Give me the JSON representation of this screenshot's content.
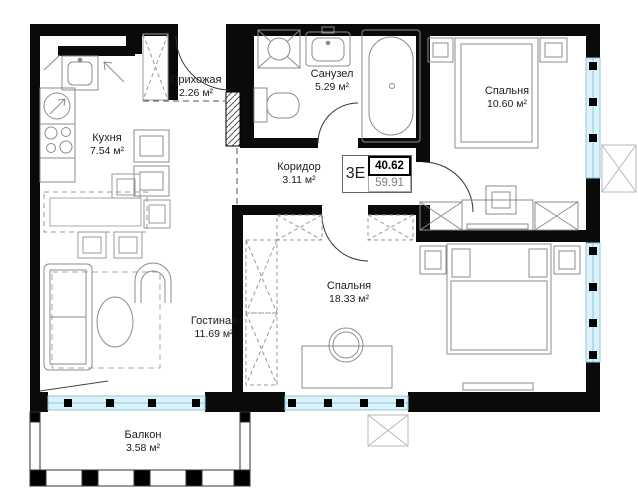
{
  "plan": {
    "info_box": {
      "type_label": "3Е",
      "area_value": "40.62",
      "area_total": "59.91"
    },
    "rooms": {
      "hallway": {
        "name": "Прихожая",
        "area": "2.26 м²"
      },
      "kitchen": {
        "name": "Кухня",
        "area": "7.54 м²"
      },
      "bathroom": {
        "name": "Санузел",
        "area": "5.29 м²"
      },
      "corridor": {
        "name": "Коридор",
        "area": "3.11 м²"
      },
      "bedroom_small": {
        "name": "Спальня",
        "area": "10.60 м²"
      },
      "bedroom_large": {
        "name": "Спальня",
        "area": "18.33 м²"
      },
      "living_room": {
        "name": "Гостиная",
        "area": "11.69 м²"
      },
      "balcony": {
        "name": "Балкон",
        "area": "3.58 м²"
      }
    },
    "colors": {
      "wall": "#0a0a0a",
      "window_fill": "#dbf2fa",
      "window_line": "#8cc8dd",
      "furniture": "#8c8c8c"
    }
  }
}
